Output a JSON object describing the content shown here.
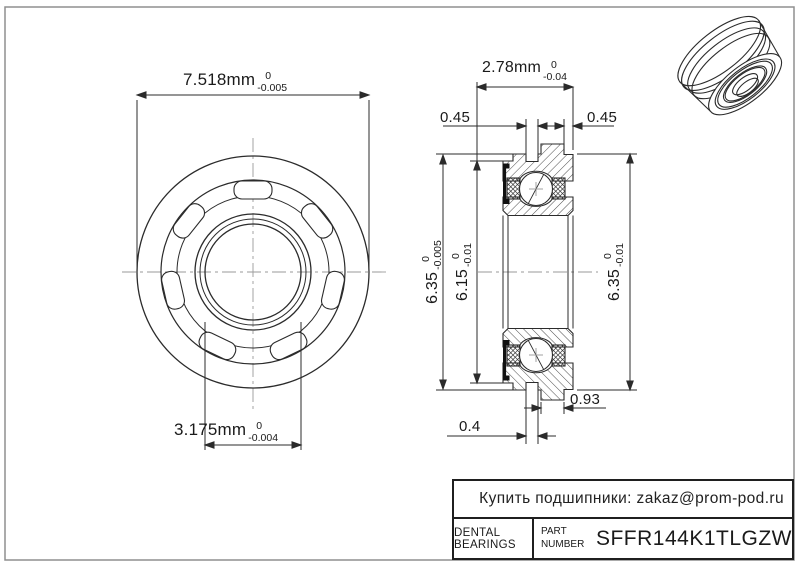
{
  "part": {
    "number": "SFFR144K1TLGZW",
    "category": "DENTAL BEARINGS"
  },
  "title_block": {
    "contact": "Купить подшипники: zakaz@prom-pod.ru",
    "brand": "DENTAL BEARINGS",
    "part_label_line1": "PART",
    "part_label_line2": "NUMBER",
    "part_number": "SFFR144K1TLGZW"
  },
  "dimensions": {
    "od_flange": {
      "value": "7.518mm",
      "tol_upper": "0",
      "tol_lower": "-0.005"
    },
    "bore": {
      "value": "3.175mm",
      "tol_upper": "0",
      "tol_lower": "-0.004"
    },
    "width": {
      "value": "2.78mm",
      "tol_upper": "0",
      "tol_lower": "-0.04"
    },
    "groove_left": "0.45",
    "groove_right": "0.45",
    "od_left": {
      "value": "6.35",
      "tol_upper": "0",
      "tol_lower": "-0.005"
    },
    "od_inner": {
      "value": "6.15",
      "tol_upper": "0",
      "tol_lower": "-0.01"
    },
    "od_right": {
      "value": "6.35",
      "tol_upper": "0",
      "tol_lower": "-0.01"
    },
    "flange_width": "0.93",
    "land_width": "0.4"
  },
  "colors": {
    "line": "#2b2b2b",
    "centerline": "#9a9a9a",
    "frame": "#8f8f8f",
    "text": "#1a1a1a",
    "seal_fill": "#111111",
    "background": "#ffffff"
  }
}
